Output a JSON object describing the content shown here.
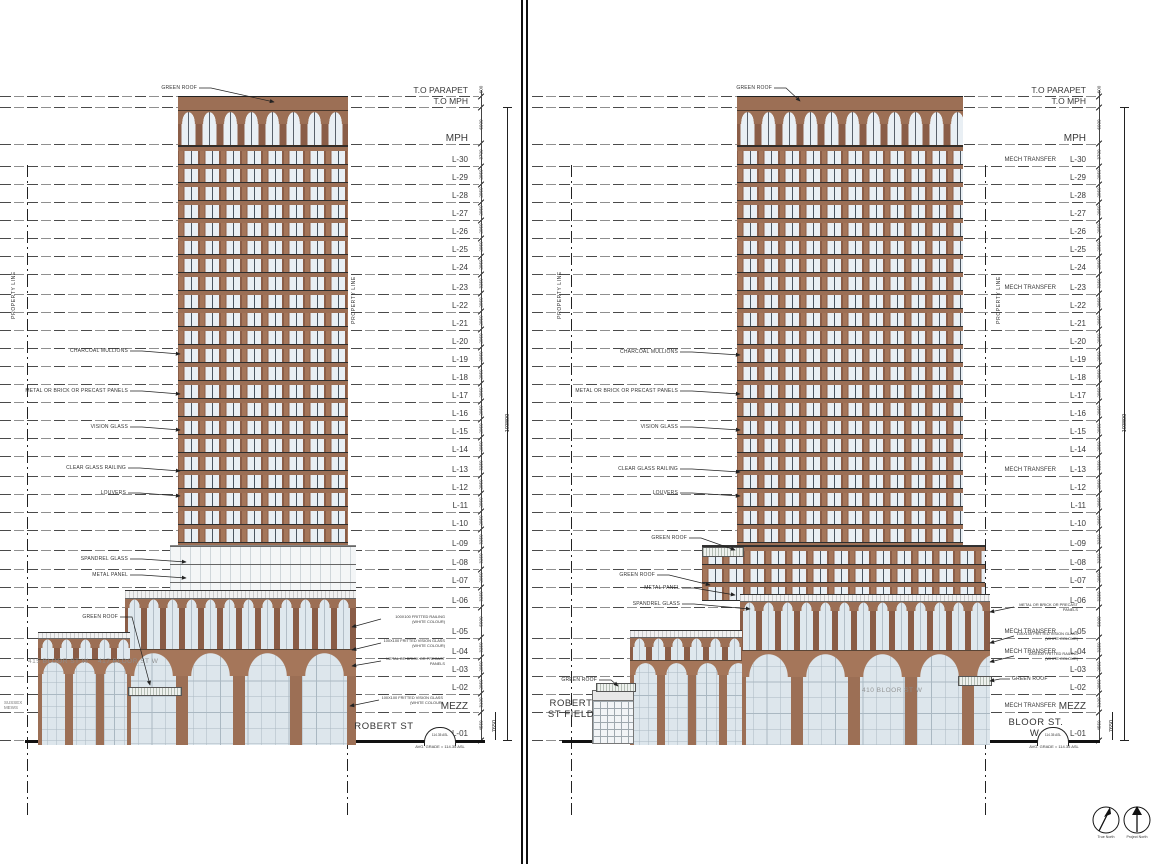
{
  "drawing": {
    "overall_dim": "103800",
    "mezz_bracket_dim": "7650",
    "property_line_label": "PROPERTY LINE",
    "mech_label": "MECH TRANSFER"
  },
  "levels": [
    {
      "label": "T.O PARAPET",
      "dim": "600",
      "mm": 600,
      "mech": false
    },
    {
      "label": "T.O MPH",
      "dim": "",
      "mm": 0,
      "mech": false
    },
    {
      "label": "MPH",
      "dim": "6000",
      "mm": 6000,
      "mech": false
    },
    {
      "label": "L-30",
      "dim": "3700",
      "mm": 3700,
      "mech": true
    },
    {
      "label": "L-29",
      "dim": "2950",
      "mm": 2950,
      "mech": false
    },
    {
      "label": "L-28",
      "dim": "2950",
      "mm": 2950,
      "mech": false
    },
    {
      "label": "L-27",
      "dim": "2950",
      "mm": 2950,
      "mech": false
    },
    {
      "label": "L-26",
      "dim": "2950",
      "mm": 2950,
      "mech": false
    },
    {
      "label": "L-25",
      "dim": "2950",
      "mm": 2950,
      "mech": false
    },
    {
      "label": "L-24",
      "dim": "2950",
      "mm": 2950,
      "mech": false
    },
    {
      "label": "L-23",
      "dim": "3250",
      "mm": 3250,
      "mech": true
    },
    {
      "label": "L-22",
      "dim": "2950",
      "mm": 2950,
      "mech": false
    },
    {
      "label": "L-21",
      "dim": "2950",
      "mm": 2950,
      "mech": false
    },
    {
      "label": "L-20",
      "dim": "2950",
      "mm": 2950,
      "mech": false
    },
    {
      "label": "L-19",
      "dim": "2950",
      "mm": 2950,
      "mech": false
    },
    {
      "label": "L-18",
      "dim": "2950",
      "mm": 2950,
      "mech": false
    },
    {
      "label": "L-17",
      "dim": "2950",
      "mm": 2950,
      "mech": false
    },
    {
      "label": "L-16",
      "dim": "2950",
      "mm": 2950,
      "mech": false
    },
    {
      "label": "L-15",
      "dim": "2950",
      "mm": 2950,
      "mech": false
    },
    {
      "label": "L-14",
      "dim": "2950",
      "mm": 2950,
      "mech": false
    },
    {
      "label": "L-13",
      "dim": "3250",
      "mm": 3250,
      "mech": true
    },
    {
      "label": "L-12",
      "dim": "2950",
      "mm": 2950,
      "mech": false
    },
    {
      "label": "L-11",
      "dim": "2950",
      "mm": 2950,
      "mech": false
    },
    {
      "label": "L-10",
      "dim": "2950",
      "mm": 2950,
      "mech": false
    },
    {
      "label": "L-09",
      "dim": "3250",
      "mm": 3250,
      "mech": false
    },
    {
      "label": "L-08",
      "dim": "3250",
      "mm": 3250,
      "mech": false
    },
    {
      "label": "L-07",
      "dim": "2950",
      "mm": 2950,
      "mech": false
    },
    {
      "label": "L-06",
      "dim": "3250",
      "mm": 3250,
      "mech": false
    },
    {
      "label": "L-05",
      "dim": "5000",
      "mm": 5000,
      "mech": true
    },
    {
      "label": "L-04",
      "dim": "3250",
      "mm": 3250,
      "mech": true
    },
    {
      "label": "L-03",
      "dim": "2950",
      "mm": 2950,
      "mech": false
    },
    {
      "label": "L-02",
      "dim": "2950",
      "mm": 2950,
      "mech": false
    },
    {
      "label": "MEZZ",
      "dim": "3100",
      "mm": 3100,
      "mech": true
    },
    {
      "label": "L-01",
      "dim": "4550",
      "mm": 4550,
      "mech": false
    }
  ],
  "panels": {
    "left": {
      "street_label": "ROBERT ST",
      "side_label": "SUSSEX MEWS",
      "ghost_signs": [
        "415 BLOOR ST W",
        "417 BLOOR ST W"
      ],
      "grade_marker": "114.35 ASL",
      "grade_note": "AVG. GRADE = 114.35 ASL",
      "callouts": [
        "GREEN ROOF",
        "CHARCOAL MULLIONS",
        "METAL OR BRICK OR PRECAST PANELS",
        "VISION GLASS",
        "CLEAR GLASS RAILING",
        "LOUVERS",
        "SPANDREL GLASS",
        "METAL PANEL",
        "GREEN ROOF"
      ],
      "detail_notes": [
        "100X100 FRITTED RAILING (WHITE COLOUR)",
        "100X100 FRITTED VISION GLASS (WHITE COLOUR)",
        "METAL OR BRICK OR PRECAST PANELS",
        "100X100 FRITTED VISION GLASS (WHITE COLOUR)"
      ]
    },
    "right": {
      "street_label": "BLOOR ST. W.",
      "field_label": "ROBERT ST FIELD",
      "ghost_signs": [
        "410 BLOOR ST W"
      ],
      "grade_marker": "114.35 ASL",
      "grade_note": "AVG. GRADE = 114.35 ASL",
      "callouts": [
        "GREEN ROOF",
        "CHARCOAL MULLIONS",
        "METAL OR BRICK OR PRECAST PANELS",
        "VISION GLASS",
        "CLEAR GLASS RAILING",
        "LOUVERS",
        "GREEN ROOF",
        "GREEN ROOF",
        "METAL PANEL",
        "SPANDREL GLASS",
        "GREEN ROOF",
        "GREEN ROOF"
      ],
      "detail_notes": [
        "METAL OR BRICK OR PRECAST PANELS",
        "100X100 FRITTED VISION GLASS (WHITE COLOUR)",
        "100X100 FRITTED RAILING (WHITE COLOUR)"
      ]
    }
  },
  "compass": {
    "true_north": "True North",
    "project_north": "Project North"
  },
  "colors": {
    "brick": "#a5765a",
    "brick_dark": "#8a5d47",
    "window": "#e9eff4",
    "line": "#3c3c3c",
    "green_roof": "#eef1ee"
  }
}
